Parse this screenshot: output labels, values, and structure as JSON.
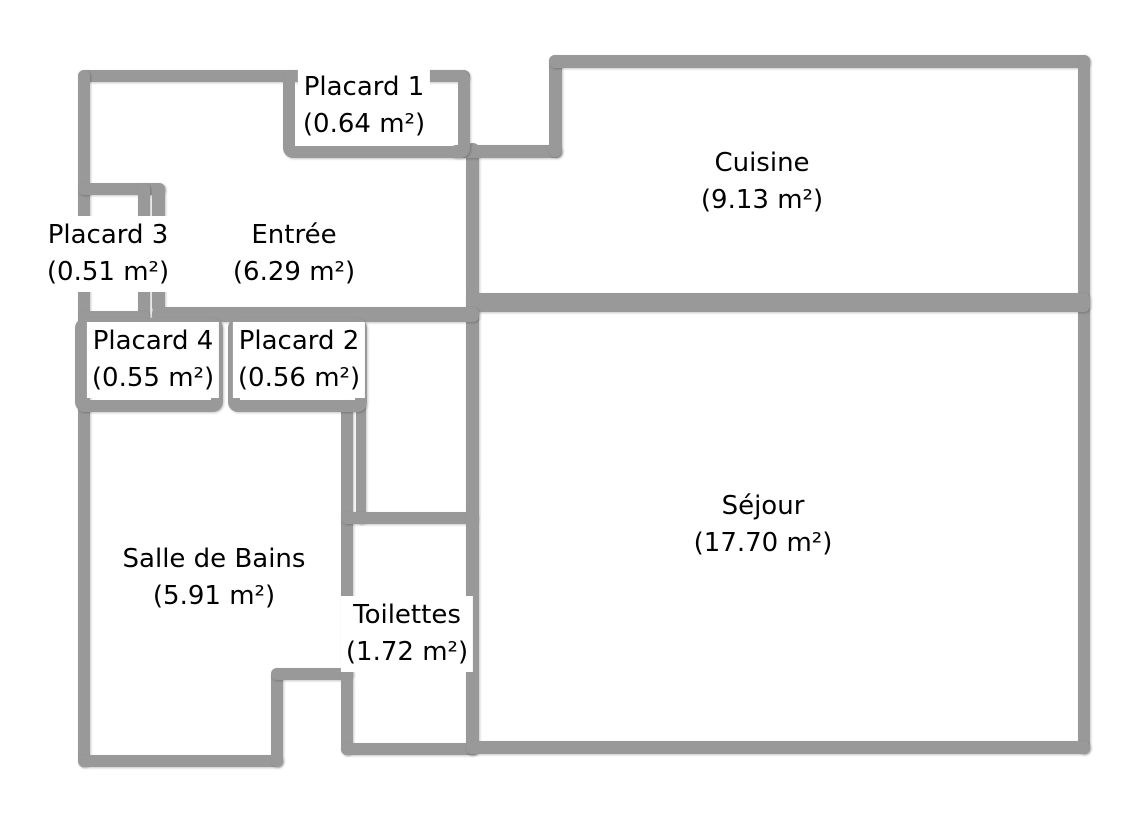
{
  "plan": {
    "background": "#ffffff",
    "wall_color": "#999999",
    "text_color": "#000000",
    "rooms": [
      {
        "id": "placard-1",
        "label": "Placard 1",
        "area": "(0.64 m²)",
        "cx": 364,
        "cy": 106
      },
      {
        "id": "cuisine",
        "label": "Cuisine",
        "area": "(9.13 m²)",
        "cx": 762,
        "cy": 182
      },
      {
        "id": "placard-3",
        "label": "Placard 3",
        "area": "(0.51 m²)",
        "cx": 108,
        "cy": 254
      },
      {
        "id": "entree",
        "label": "Entrée",
        "area": "(6.29 m²)",
        "cx": 294,
        "cy": 254
      },
      {
        "id": "placard-4",
        "label": "Placard 4",
        "area": "(0.55 m²)",
        "cx": 153,
        "cy": 360
      },
      {
        "id": "placard-2",
        "label": "Placard 2",
        "area": "(0.56 m²)",
        "cx": 299,
        "cy": 360
      },
      {
        "id": "salle-de-bains",
        "label": "Salle de Bains",
        "area": "(5.91 m²)",
        "cx": 214,
        "cy": 578
      },
      {
        "id": "toilettes",
        "label": "Toilettes",
        "area": "(1.72 m²)",
        "cx": 407,
        "cy": 634
      },
      {
        "id": "sejour",
        "label": "Séjour",
        "area": "(17.70 m²)",
        "cx": 763,
        "cy": 525
      }
    ],
    "walls": [
      {
        "id": "entree-top-wall",
        "x": 78,
        "y": 70,
        "w": 392,
        "h": 12
      },
      {
        "id": "left-exterior-wall",
        "x": 78,
        "y": 70,
        "w": 12,
        "h": 697
      },
      {
        "id": "bathroom-bottom-wall",
        "x": 78,
        "y": 755,
        "w": 205,
        "h": 12
      },
      {
        "id": "notch-vertical-wall",
        "x": 271,
        "y": 668,
        "w": 12,
        "h": 99
      },
      {
        "id": "notch-horizontal-wall",
        "x": 271,
        "y": 668,
        "w": 82,
        "h": 12
      },
      {
        "id": "bath-toilet-wall",
        "x": 341,
        "y": 400,
        "w": 12,
        "h": 355
      },
      {
        "id": "bath-toilet-seam-wall",
        "x": 356,
        "y": 400,
        "w": 10,
        "h": 124
      },
      {
        "id": "toilettes-top-wall",
        "x": 341,
        "y": 512,
        "w": 137,
        "h": 12
      },
      {
        "id": "toilettes-bottom-wall",
        "x": 341,
        "y": 743,
        "w": 137,
        "h": 12
      },
      {
        "id": "central-vertical-wall",
        "x": 466,
        "y": 143,
        "w": 13,
        "h": 612
      },
      {
        "id": "connector-wall",
        "x": 450,
        "y": 145,
        "w": 112,
        "h": 13
      },
      {
        "id": "cuisine-left-riser",
        "x": 549,
        "y": 55,
        "w": 13,
        "h": 102
      },
      {
        "id": "top-exterior-wall",
        "x": 549,
        "y": 55,
        "w": 541,
        "h": 13
      },
      {
        "id": "right-exterior-wall",
        "x": 1078,
        "y": 55,
        "w": 12,
        "h": 699
      },
      {
        "id": "cuisine-sejour-wall",
        "x": 466,
        "y": 293,
        "w": 624,
        "h": 19
      },
      {
        "id": "sejour-bottom-wall",
        "x": 466,
        "y": 741,
        "w": 624,
        "h": 13
      },
      {
        "id": "placard3-top-wall",
        "x": 78,
        "y": 183,
        "w": 87,
        "h": 12
      },
      {
        "id": "placard3-right-wall",
        "x": 138,
        "y": 183,
        "w": 12,
        "h": 140
      },
      {
        "id": "entree-west-wall",
        "x": 152,
        "y": 183,
        "w": 13,
        "h": 130
      },
      {
        "id": "entree-bottom-wall",
        "x": 152,
        "y": 307,
        "w": 327,
        "h": 15
      },
      {
        "id": "placard3-bottom-wall",
        "x": 78,
        "y": 311,
        "w": 72,
        "h": 12
      }
    ],
    "closet_boxes": [
      {
        "id": "placard-1-box",
        "x": 283,
        "y": 70,
        "w": 187,
        "h": 88
      },
      {
        "id": "placard-4-box",
        "x": 75,
        "y": 318,
        "w": 148,
        "h": 94
      },
      {
        "id": "placard-2-box",
        "x": 228,
        "y": 318,
        "w": 139,
        "h": 94
      }
    ]
  }
}
